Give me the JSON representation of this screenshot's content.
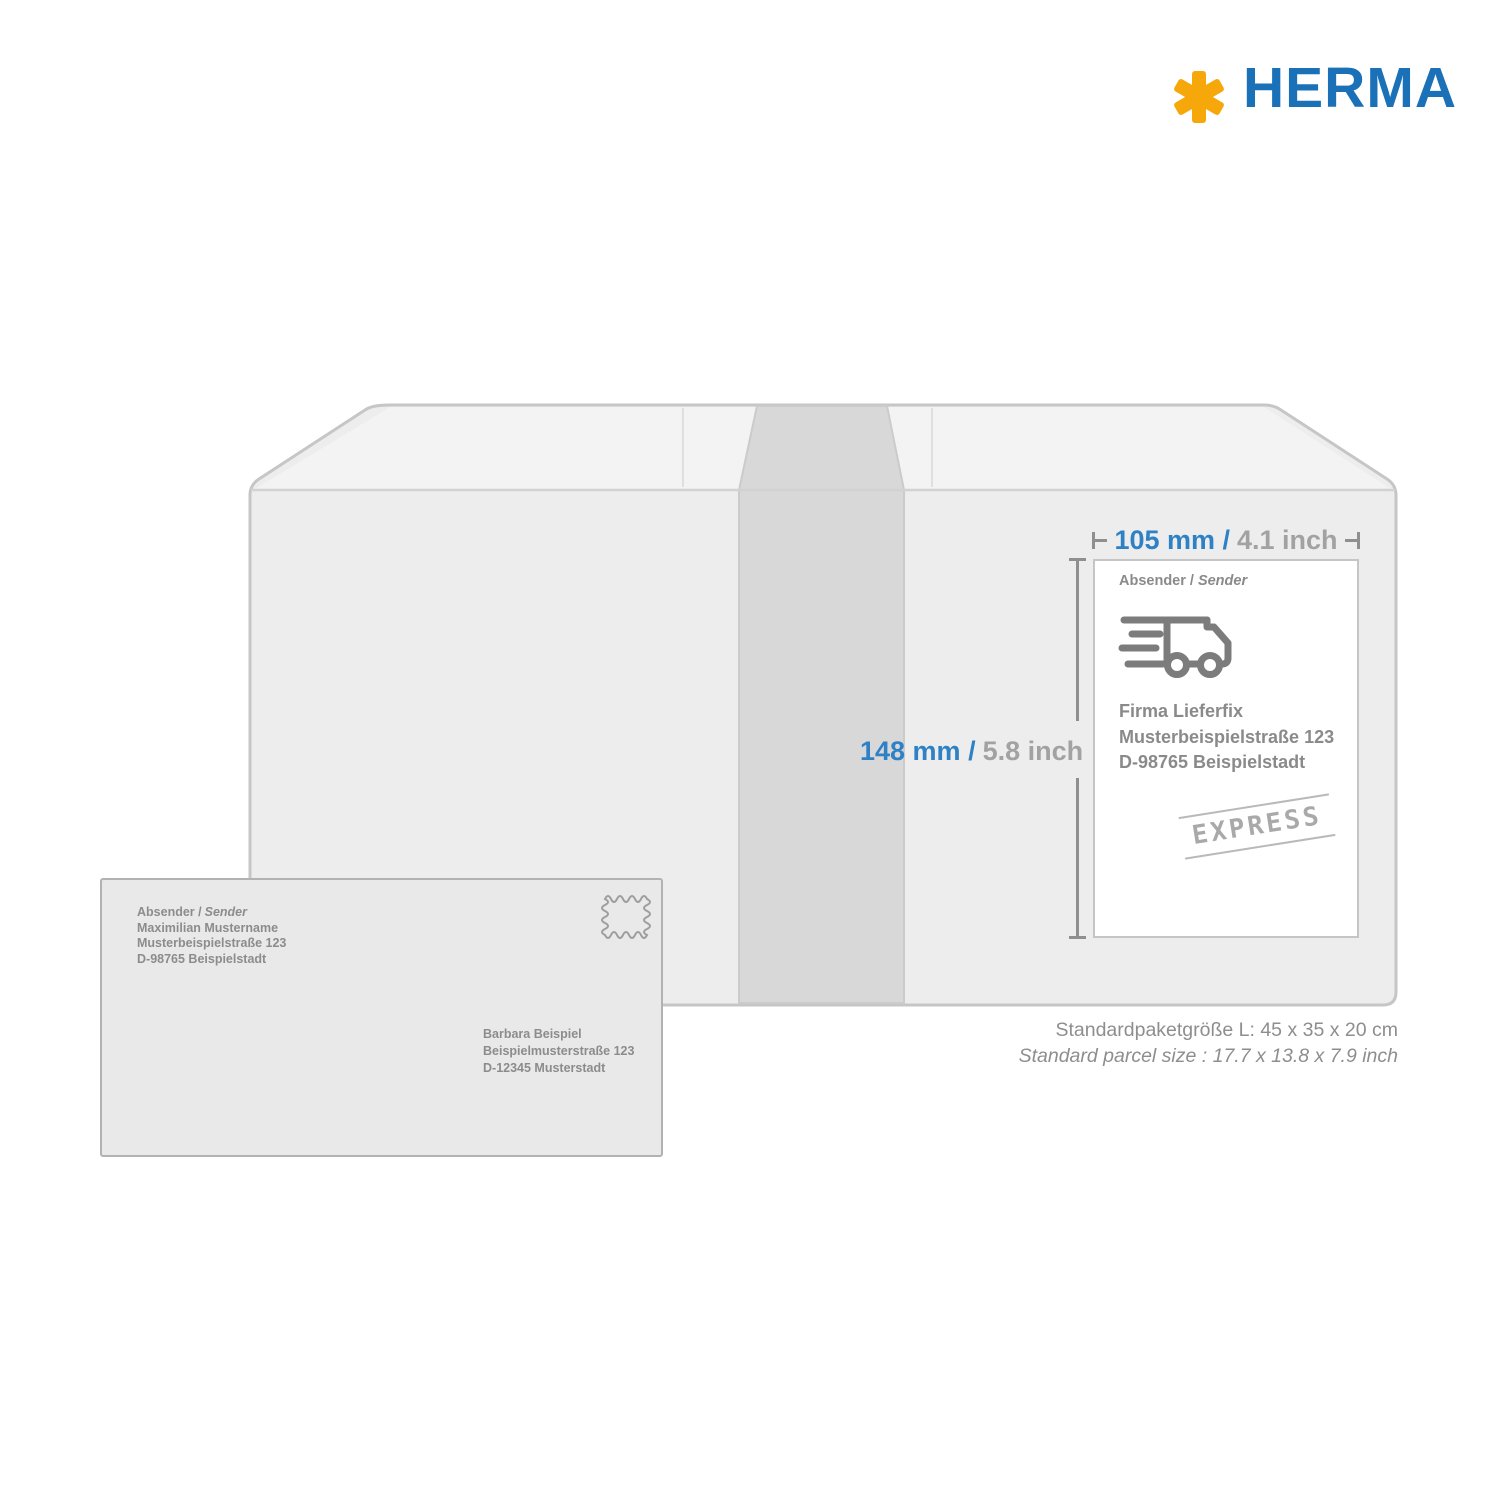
{
  "logo": {
    "brand": "HERMA",
    "asterisk_color": "#F6A80A",
    "brand_color": "#1A71B8"
  },
  "colors": {
    "dimension_blue": "#2E81C4",
    "dimension_gray": "#A2A2A2",
    "dimension_line": "#8F8F8F",
    "text_gray": "#8A8A8A",
    "box_fill": "#EDEDED",
    "box_border": "#C6C6C6",
    "tape_fill": "#D8D8D8",
    "label_border": "#C5C5C5",
    "envelope_fill": "#E9E9E9",
    "envelope_border": "#B2B2B2"
  },
  "dimensions": {
    "width": {
      "metric": "105 mm /",
      "imperial": "4.1 inch"
    },
    "height": {
      "metric": "148 mm /",
      "imperial": "5.8 inch"
    }
  },
  "label": {
    "sender_heading_de": "Absender /",
    "sender_heading_en": "Sender",
    "truck_icon": "delivery-truck-icon",
    "address_lines": [
      "Firma Lieferfix",
      "Musterbeispielstraße 123",
      "D-98765 Beispielstadt"
    ],
    "stamp": "EXPRESS"
  },
  "envelope": {
    "sender_heading_de": "Absender /",
    "sender_heading_en": "Sender",
    "sender_lines": [
      "Maximilian Mustername",
      "Musterbeispielstraße 123",
      "D-98765 Beispielstadt"
    ],
    "stamp_icon": "postage-stamp-icon",
    "recipient_lines": [
      "Barbara Beispiel",
      "Beispielmusterstraße 123",
      "D-12345 Musterstadt"
    ]
  },
  "caption": {
    "line1": "Standardpaketgröße L: 45 x 35 x 20 cm",
    "line2": "Standard parcel size : 17.7 x 13.8 x 7.9 inch"
  }
}
